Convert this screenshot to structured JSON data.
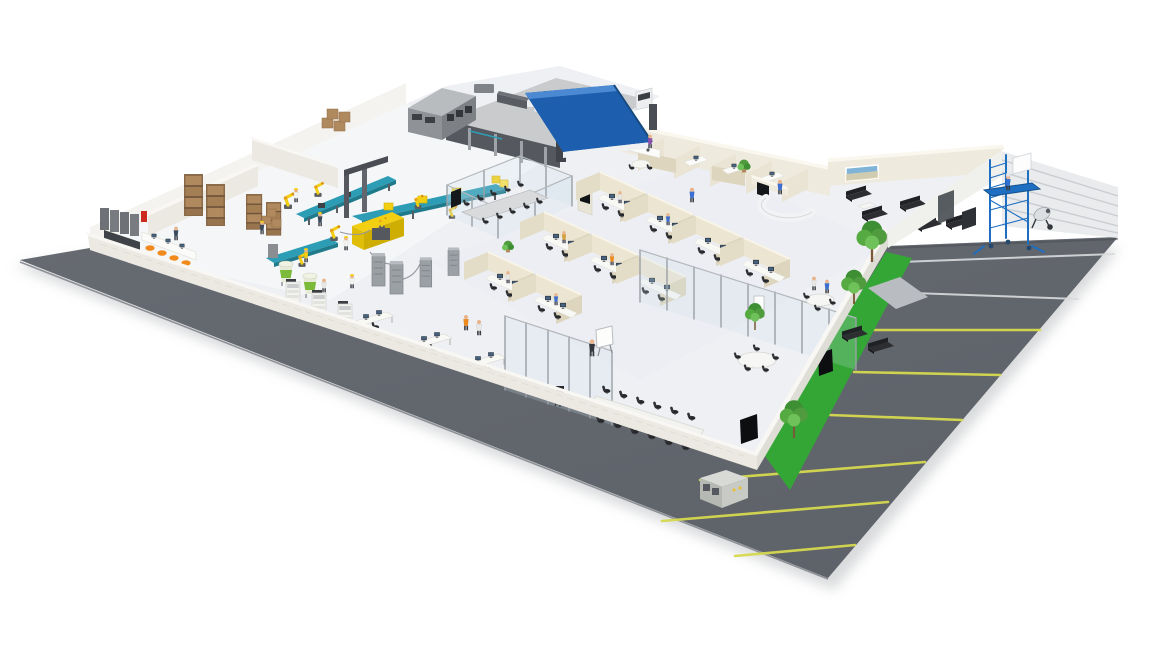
{
  "scene": {
    "kind": "isometric-facility-illustration",
    "description": "3D cutaway overview of a company site: production line, warehouse, open offices, meeting rooms, reception lounge, truck loading yard, parking lot and a construction corner",
    "background": "#ffffff",
    "text_visible": "none"
  },
  "palette": {
    "background": "#ffffff",
    "asphalt": "#62666d",
    "asphalt_edge": "#8d9197",
    "line_yellow": "#d6d94e",
    "line_white": "#d9dbdd",
    "grass": "#33a636",
    "floor": "#eef0f4",
    "wall_white": "#f3f2ee",
    "wall_beige": "#efeade",
    "partition_beige": "#eae4d4",
    "wall_corrugated": "#e9ebed",
    "glass": "#cfe0ea",
    "glass_frame": "#9aa0a6",
    "roof_blue": "#1d5fae",
    "roof_blue_light": "#4b8ad2",
    "yard": "#c9cbcd",
    "dock_dark": "#55595f",
    "building_gray": "#8f9398",
    "machine_yellow": "#f2cf12",
    "conveyor_teal": "#2d9db5",
    "hopper_green": "#7cba3a",
    "rack_brown": "#8a6a48",
    "box_brown": "#b08a5e",
    "furniture_black": "#27292c",
    "sofa_black": "#2c2e31",
    "desk_white": "#f8f8f5",
    "scaffold_blue": "#1e6ec2",
    "alert_red": "#cc2a1e",
    "skin": "#e9b38c",
    "shirt_blue": "#3b6fd4",
    "shirt_orange": "#f08a1d",
    "tree_green": "#55aa41",
    "trunk_brown": "#7a5a38",
    "shadow": "#b9bcbf"
  },
  "zones": [
    {
      "id": "loading-yard",
      "label": "truck loading yard",
      "objects": [
        "semi-truck",
        "vans",
        "cars",
        "loading-dock",
        "blue-roof",
        "gray-warehouse-building"
      ]
    },
    {
      "id": "warehouse",
      "label": "warehouse storage",
      "objects": [
        "pallet-racks",
        "cardboard-boxes",
        "lockers",
        "fire-cabinet",
        "control-counter",
        "orange-chairs"
      ]
    },
    {
      "id": "production",
      "label": "production line",
      "objects": [
        "robotic-arms",
        "conveyor-belts",
        "machine-cell",
        "hoppers",
        "server-cabinets",
        "workers-with-helmets"
      ]
    },
    {
      "id": "open-office",
      "label": "open office cubicles",
      "objects": [
        "cubicle-pods",
        "monitors",
        "office-chairs",
        "seated-staff"
      ]
    },
    {
      "id": "training-room",
      "label": "glass training room",
      "objects": [
        "long-table",
        "chairs",
        "wall-display"
      ]
    },
    {
      "id": "conference-room",
      "label": "conference room",
      "objects": [
        "long-white-table",
        "black-chairs",
        "presenter",
        "whiteboard",
        "tv-screen",
        "camera-tripod"
      ]
    },
    {
      "id": "meeting-area",
      "label": "glass meeting area",
      "objects": [
        "round-tables",
        "flipchart",
        "benches",
        "tv-screen",
        "indoor-tree"
      ]
    },
    {
      "id": "reception",
      "label": "reception lobby",
      "objects": [
        "curved-desk",
        "receptionist",
        "display-totem",
        "potted-plant"
      ]
    },
    {
      "id": "lounge",
      "label": "waiting lounge",
      "objects": [
        "black-sofas",
        "coffee-tables",
        "wall-picture"
      ]
    },
    {
      "id": "kitchen-offices",
      "label": "kitchen and small offices",
      "objects": [
        "counters",
        "fridge",
        "dining-table",
        "desks"
      ]
    },
    {
      "id": "parking",
      "label": "parking lot",
      "objects": [
        "yellow-bay-lines",
        "white-row-lines",
        "walkway"
      ]
    },
    {
      "id": "landscaping",
      "label": "grass strips and trees",
      "objects": [
        "grass-band",
        "trees"
      ]
    },
    {
      "id": "construction",
      "label": "construction corner",
      "objects": [
        "corrugated-wall",
        "blue-scaffold-tower",
        "worker",
        "cement-mixer"
      ]
    },
    {
      "id": "exterior",
      "label": "site exterior",
      "objects": [
        "perimeter-road",
        "hvac-unit",
        "drop-shadow"
      ]
    }
  ],
  "counts": {
    "outdoor_trees": 3,
    "indoor_plants": 3,
    "parking_yellow_lines": 6,
    "parking_white_lines": 2,
    "cubicle_pods": 9,
    "conference_chairs": 13,
    "lounge_sofas": 4,
    "robot_arms": 6,
    "hoppers": 2,
    "pallet_racks": 4,
    "yard_vehicles": 5,
    "people_approx": 24
  }
}
